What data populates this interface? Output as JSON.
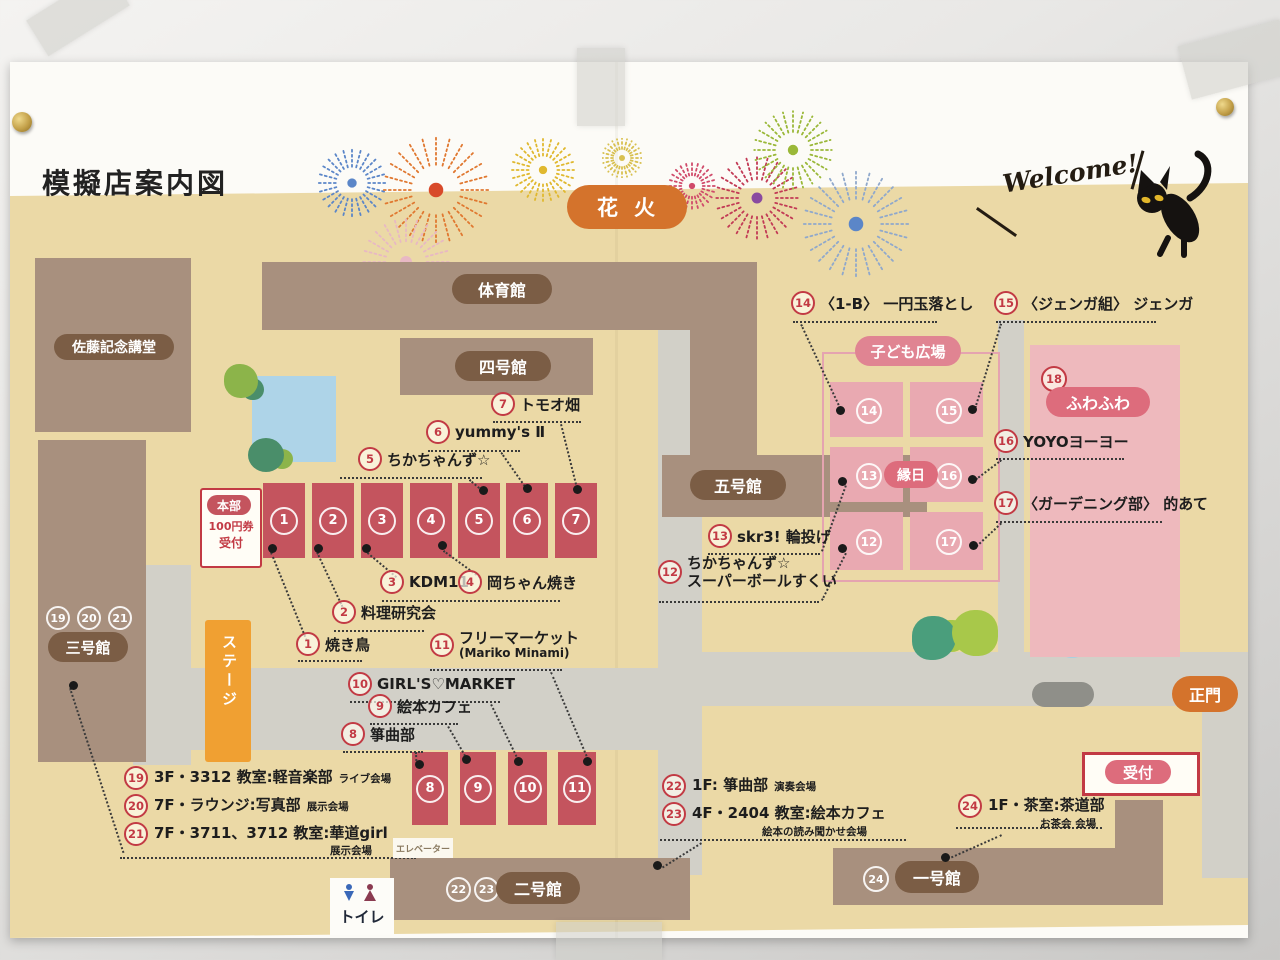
{
  "title": "模擬店案内図",
  "header": {
    "hanabi": "花火",
    "welcome": "Welcome!"
  },
  "buildings": {
    "sato": "佐藤記念講堂",
    "gym": "体育館",
    "b4": "四号館",
    "b5": "五号館",
    "b3": "三号館",
    "b2": "二号館",
    "b1": "一号館",
    "b3_nums": [
      "19",
      "20",
      "21"
    ],
    "b2_nums": [
      "22",
      "23"
    ],
    "b1_num": "24"
  },
  "hq": {
    "label": "本部",
    "line1": "100円券",
    "line2": "受付"
  },
  "reception": "受付",
  "main_gate": "正門",
  "stage": "ステージ",
  "toilet": "トイレ",
  "elevator": "エレベーター",
  "kids_plaza": {
    "title": "子ども広場",
    "ennichi": "縁日",
    "cells": [
      "14",
      "15",
      "13",
      "16",
      "12",
      "17"
    ]
  },
  "fuwafuwa": {
    "num": "18",
    "label": "ふわふわ"
  },
  "stalls_top": [
    "1",
    "2",
    "3",
    "4",
    "5",
    "6",
    "7"
  ],
  "stalls_bottom": [
    "8",
    "9",
    "10",
    "11"
  ],
  "labels": [
    {
      "num": "1",
      "text": "焼き鳥"
    },
    {
      "num": "2",
      "text": "料理研究会"
    },
    {
      "num": "3",
      "text": "KDM11"
    },
    {
      "num": "4",
      "text": "岡ちゃん焼き"
    },
    {
      "num": "5",
      "text": "ちかちゃんず☆"
    },
    {
      "num": "6",
      "text": "yummy's Ⅱ"
    },
    {
      "num": "7",
      "text": "トモオ畑"
    },
    {
      "num": "8",
      "text": "箏曲部"
    },
    {
      "num": "9",
      "text": "絵本カフェ"
    },
    {
      "num": "10",
      "text": "GIRL'S♡MARKET"
    },
    {
      "num": "11",
      "text": "フリーマーケット",
      "sub": "(Mariko Minami)"
    },
    {
      "num": "12",
      "text": "ちかちゃんず☆",
      "sub": "スーパーボールすくい"
    },
    {
      "num": "13",
      "text": "skr3! 輪投げ"
    },
    {
      "num": "14",
      "text": "〈1-B〉 一円玉落とし"
    },
    {
      "num": "15",
      "text": "〈ジェンガ組〉 ジェンガ"
    },
    {
      "num": "16",
      "text": "YOYOヨーヨー"
    },
    {
      "num": "17",
      "text": "〈ガーデニング部〉 的あて"
    }
  ],
  "rooms": [
    {
      "num": "19",
      "text": "3F・3312 教室:軽音楽部",
      "sub": "ライブ会場"
    },
    {
      "num": "20",
      "text": "7F・ラウンジ:写真部",
      "sub": "展示会場"
    },
    {
      "num": "21",
      "text": "7F・3711、3712 教室:華道girl",
      "sub": "展示会場"
    },
    {
      "num": "22",
      "text": "1F: 箏曲部",
      "sub": "演奏会場"
    },
    {
      "num": "23",
      "text": "4F・2404 教室:絵本カフェ",
      "sub": "絵本の読み聞かせ会場"
    },
    {
      "num": "24",
      "text": "1F・茶室:茶道部",
      "sub": "お茶会 会場"
    }
  ]
}
